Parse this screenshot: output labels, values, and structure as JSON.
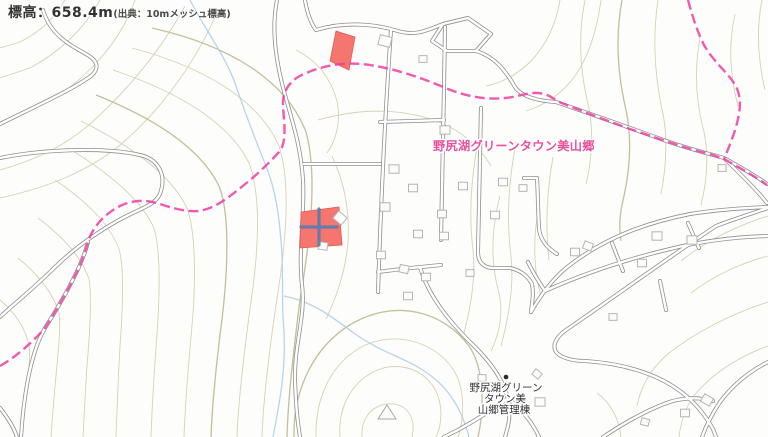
{
  "header": {
    "elevation_label": "標高：658.4m",
    "elevation_source": "(出典：10mメッシュ標高)"
  },
  "map": {
    "labels": {
      "town_name": "野尻湖グリーンタウン美山郷",
      "facility_name_lines": [
        "野尻湖グリーン",
        "タウン美",
        "山郷管理棟"
      ]
    },
    "colors": {
      "background": "#fdfdfb",
      "contour": "#d6d2b2",
      "contour_index": "#c6c09a",
      "road_casing": "#8f8f8f",
      "road_fill": "#ffffff",
      "building_outline": "#b5b5b5",
      "boundary_pink": "#ef3da2",
      "selection_red": "#f4766e",
      "crosshair_blue": "#5b7cb0",
      "stream_blue": "#abcde8",
      "town_label_pink": "#e8509c",
      "text_dark": "#333333"
    },
    "selection": {
      "parcel_a_points": "336,31 355,37 349,70 330,61",
      "parcel_b_points": "301,212 339,207 342,245 300,248"
    },
    "crosshair": {
      "x": 319,
      "y": 227,
      "arm": 18
    },
    "buildings": [
      [
        385,
        41,
        12,
        14
      ],
      [
        423,
        59,
        8,
        0
      ],
      [
        445,
        130,
        10,
        0
      ],
      [
        394,
        169,
        10,
        0
      ],
      [
        413,
        188,
        9,
        0
      ],
      [
        463,
        186,
        9,
        0
      ],
      [
        503,
        182,
        9,
        0
      ],
      [
        523,
        188,
        8,
        0
      ],
      [
        385,
        207,
        10,
        0
      ],
      [
        495,
        215,
        9,
        0
      ],
      [
        442,
        214,
        9,
        0
      ],
      [
        418,
        234,
        9,
        0
      ],
      [
        444,
        236,
        9,
        0
      ],
      [
        340,
        218,
        11,
        40
      ],
      [
        323,
        246,
        9,
        8
      ],
      [
        381,
        255,
        9,
        0
      ],
      [
        404,
        269,
        9,
        12
      ],
      [
        426,
        277,
        9,
        0
      ],
      [
        470,
        273,
        8,
        0
      ],
      [
        408,
        296,
        9,
        0
      ],
      [
        575,
        252,
        9,
        0
      ],
      [
        588,
        246,
        9,
        20
      ],
      [
        642,
        263,
        9,
        0
      ],
      [
        657,
        236,
        10,
        0
      ],
      [
        692,
        240,
        10,
        0
      ],
      [
        722,
        168,
        8,
        0
      ],
      [
        613,
        317,
        8,
        0
      ],
      [
        537,
        374,
        8,
        40
      ],
      [
        540,
        402,
        10,
        0
      ],
      [
        482,
        378,
        8,
        0
      ],
      [
        707,
        400,
        10,
        30
      ],
      [
        685,
        413,
        9,
        0
      ],
      [
        645,
        422,
        8,
        15
      ]
    ],
    "landmarks": {
      "dot": {
        "x": 506,
        "y": 377
      },
      "triangle_points": "387,405 378,419 396,419"
    }
  }
}
